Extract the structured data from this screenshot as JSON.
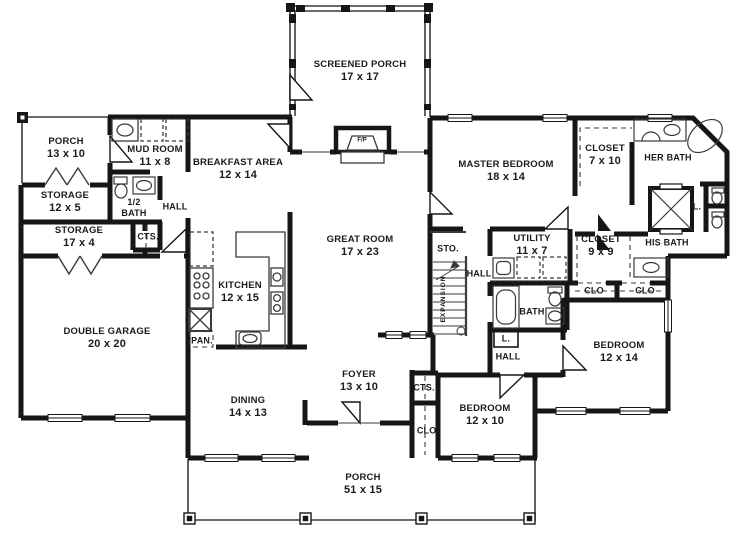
{
  "plan": {
    "type": "house-floor-plan",
    "colors": {
      "wall": "#161616",
      "background": "#ffffff",
      "thin_line": "#3a3a3a"
    },
    "rooms": {
      "porch_left": {
        "name": "PORCH",
        "dims": "13 x 10"
      },
      "storage_a": {
        "name": "STORAGE",
        "dims": "12 x 5"
      },
      "storage_b": {
        "name": "STORAGE",
        "dims": "17 x 4"
      },
      "mud_room": {
        "name": "MUD ROOM",
        "dims": "11 x 8"
      },
      "breakfast": {
        "name": "BREAKFAST AREA",
        "dims": "12 x 14"
      },
      "screened_porch": {
        "name": "SCREENED PORCH",
        "dims": "17 x 17"
      },
      "master_bedroom": {
        "name": "MASTER BEDROOM",
        "dims": "18 x 14"
      },
      "closet_her": {
        "name": "CLOSET",
        "dims": "7 x 10"
      },
      "her_bath": {
        "name": "HER BATH"
      },
      "his_bath": {
        "name": "HIS BATH"
      },
      "great_room": {
        "name": "GREAT ROOM",
        "dims": "17 x 23"
      },
      "kitchen": {
        "name": "KITCHEN",
        "dims": "12 x 15"
      },
      "utility": {
        "name": "UTILITY",
        "dims": "11 x 7"
      },
      "closet_his": {
        "name": "CLOSET",
        "dims": "9 x 9"
      },
      "bath_middle": {
        "name": "BATH"
      },
      "bedroom_right": {
        "name": "BEDROOM",
        "dims": "12 x 14"
      },
      "bedroom_front": {
        "name": "BEDROOM",
        "dims": "12 x 10"
      },
      "foyer": {
        "name": "FOYER",
        "dims": "13 x 10"
      },
      "dining": {
        "name": "DINING",
        "dims": "14 x 13"
      },
      "garage": {
        "name": "DOUBLE GARAGE",
        "dims": "20 x 20"
      },
      "porch_front": {
        "name": "PORCH",
        "dims": "51 x 15"
      }
    },
    "labels": {
      "hall": "HALL",
      "cts": "CTS.",
      "clo": "CLO",
      "clo_dot": "CLO.",
      "sto": "STO.",
      "pan": "PAN.",
      "linen": "L.",
      "expansion": "EXPANSION",
      "fireplace": "F/P",
      "half_bath_line1": "1/2",
      "half_bath_line2": "BATH"
    }
  }
}
